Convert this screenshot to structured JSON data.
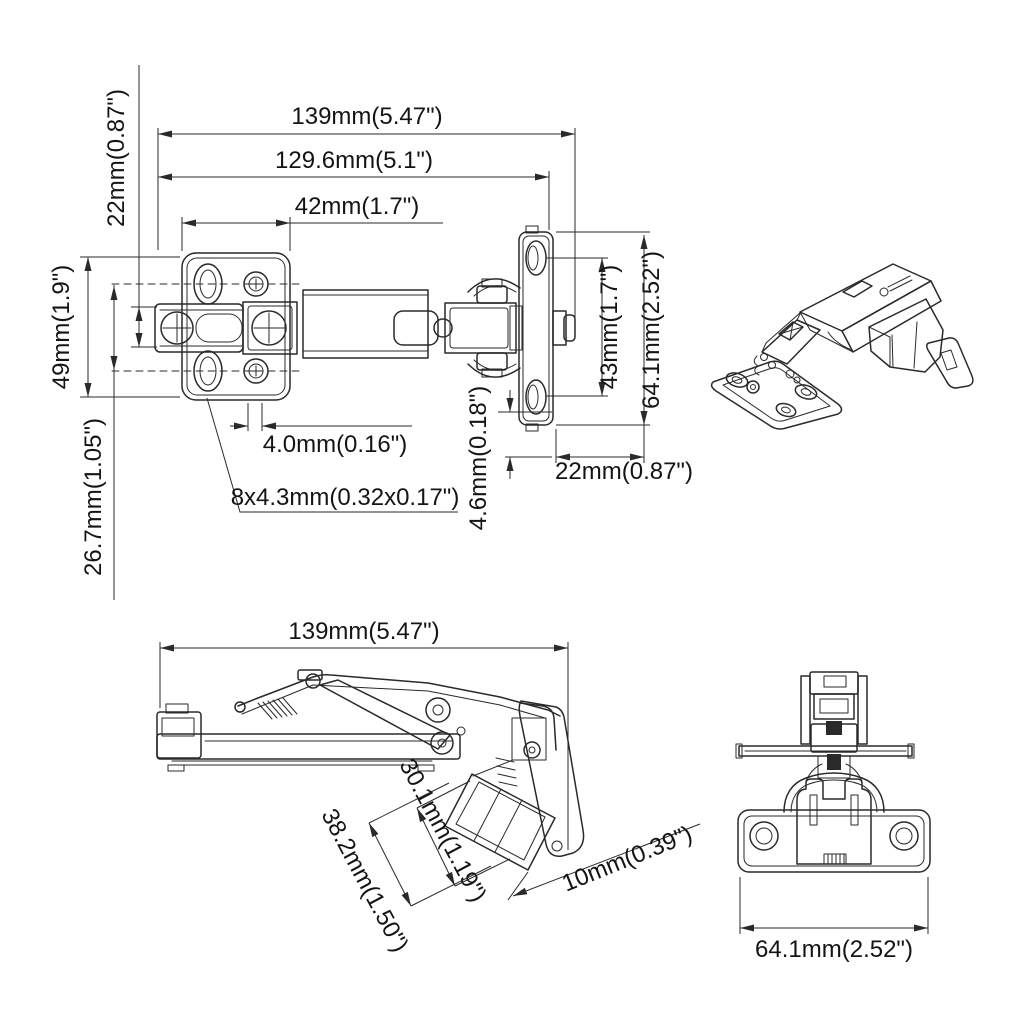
{
  "page": {
    "background": "#ffffff",
    "line_color": "#2a2a2a",
    "text_color": "#141414",
    "description": "Technical dimension drawing of a 175-degree face-frame cabinet hinge, four views"
  },
  "views": {
    "top_view": {
      "dims": {
        "length_total": "139mm(5.47\")",
        "length_arm": "129.6mm(5.1\")",
        "plate_width": "42mm(1.7\")",
        "offset_left": "22mm(0.87\")",
        "plate_height": "49mm(1.9\")",
        "plate_lower": "26.7mm(1.05\")",
        "slot_gap": "4.0mm(0.16\")",
        "holes": "8x4.3mm(0.32x0.17\")",
        "cup_gap": "4.6mm(0.18\")",
        "cup_hole_spacing": "43mm(1.7\")",
        "cup_plate_height": "64.1mm(2.52\")",
        "cup_offset": "22mm(0.87\")"
      }
    },
    "side_view": {
      "dims": {
        "length_total": "139mm(5.47\")",
        "cup_depth": "30.1mm(1.19\")",
        "cup_total": "38.2mm(1.50\")",
        "cup_clearance": "10mm(0.39\")"
      }
    },
    "front_view": {
      "dims": {
        "plate_length": "64.1mm(2.52\")"
      }
    }
  }
}
